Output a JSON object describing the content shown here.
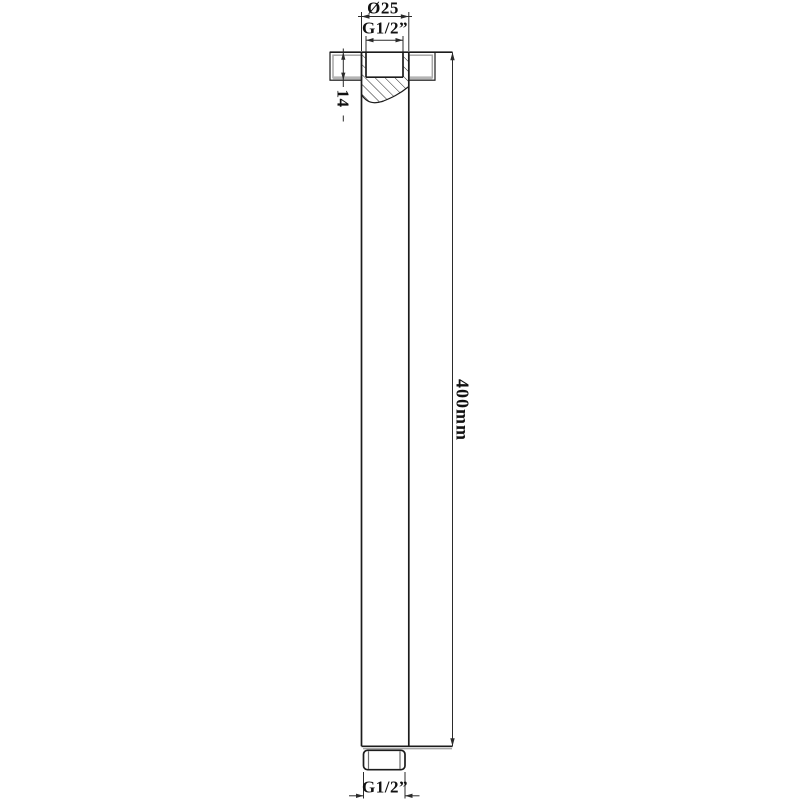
{
  "labels": {
    "diameter": "Ø25",
    "thread_top": "G1/2”",
    "flange_height": "14",
    "length": "400mm",
    "thread_bottom": "G1/2”"
  },
  "colors": {
    "background": "#ffffff",
    "line": "#1c1c1c",
    "dimension": "#2b2b2b",
    "text": "#111111",
    "accent_gray": "#a6a6a6"
  }
}
